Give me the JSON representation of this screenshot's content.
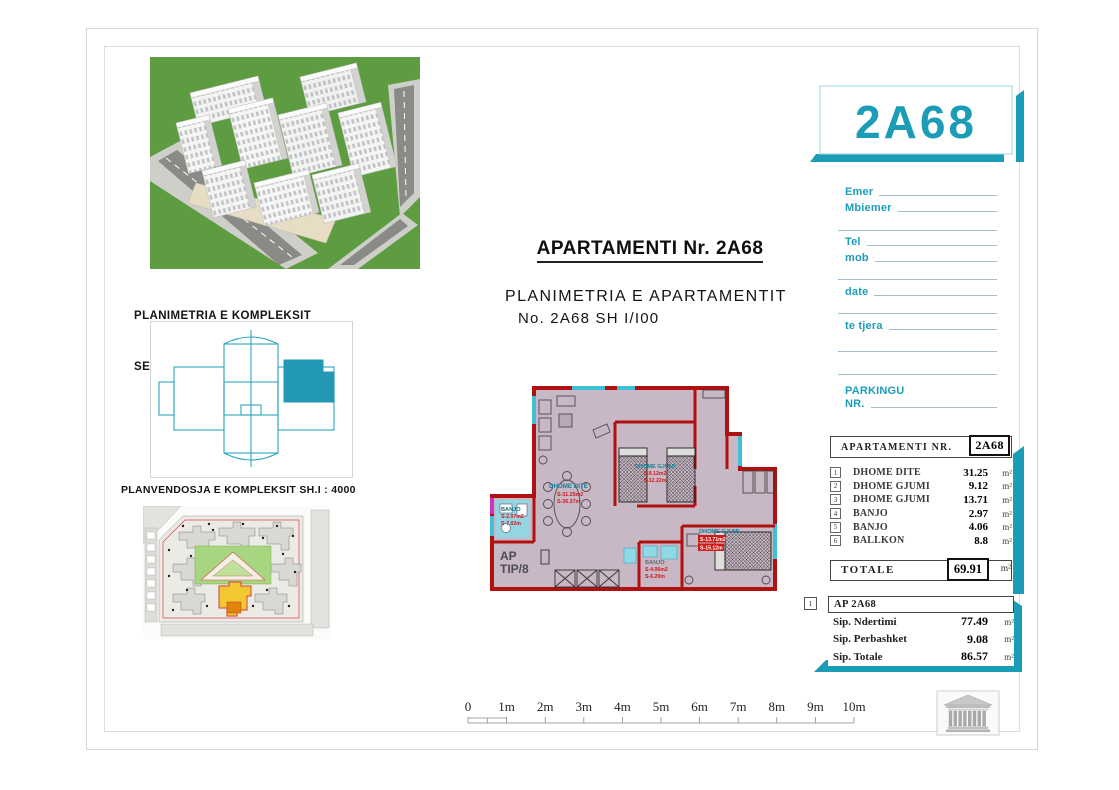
{
  "sheet": {
    "badge": "2A68",
    "title": "APARTAMENTI Nr. 2A68",
    "subtitle1": "PLANIMETRIA E APARTAMENTIT",
    "subtitle2": "No. 2A68 SH I/I00",
    "complex_caption1": "PLANIMETRIA E KOMPLEKSIT",
    "complex_caption2": "SEKSIONI 2   SH I/750",
    "siteplan_caption": "PLANVENDOSJA E KOMPLEKSIT SH.I : 4000"
  },
  "form": {
    "emer": "Emer",
    "mbiemer": "Mbiemer",
    "tel": "Tel",
    "mob": "mob",
    "date": "date",
    "te_tjera": "te tjera",
    "parkingu": "PARKINGU",
    "nr": "NR."
  },
  "rooms_table": {
    "header_label": "APARTAMENTI  NR.",
    "header_value": "2A68",
    "unit_suffix": "m²",
    "rows": [
      {
        "no": "1",
        "name": "DHOME DITE",
        "area": "31.25"
      },
      {
        "no": "2",
        "name": "DHOME GJUMI",
        "area": "9.12"
      },
      {
        "no": "3",
        "name": "DHOME GJUMI",
        "area": "13.71"
      },
      {
        "no": "4",
        "name": "BANJO",
        "area": "2.97"
      },
      {
        "no": "5",
        "name": "BANJO",
        "area": "4.06"
      },
      {
        "no": "6",
        "name": "BALLKON",
        "area": "8.8"
      }
    ],
    "total_label": "TOTALE",
    "total_value": "69.91"
  },
  "summary_table": {
    "index": "1",
    "header": "AP 2A68",
    "unit_suffix": "m²",
    "rows": [
      {
        "name": "Sip. Ndertimi",
        "value": "77.49"
      },
      {
        "name": "Sip. Perbashket",
        "value": "9.08"
      },
      {
        "name": "Sip. Totale",
        "value": "86.57"
      }
    ]
  },
  "floorplan": {
    "ap_line1": "AP",
    "ap_line2": "TIP/8",
    "living": {
      "name": "DHOME DITE",
      "area": "S-31.25m2",
      "perim": "S-36.37m"
    },
    "bedroom1": {
      "name": "DHOME GJUMI",
      "area": "S-9.12m2",
      "perim": "S-12.22m"
    },
    "bedroom2": {
      "name": "DHOME GJUMI",
      "area": "S-13.71m2",
      "perim": "S-15.12m"
    },
    "bath1": {
      "name": "BANJO",
      "area": "S-2.97m2",
      "perim": "S-7.02m"
    },
    "bath2": {
      "name": "BANJO",
      "area": "S-4.06m2",
      "perim": "S-6.20m"
    }
  },
  "scalebar": [
    "0",
    "1m",
    "2m",
    "3m",
    "4m",
    "5m",
    "6m",
    "7m",
    "8m",
    "9m",
    "10m"
  ],
  "colors": {
    "accent": "#1b9db8",
    "wall_red": "#b01010",
    "floor_mauve": "#c8b7c4"
  }
}
